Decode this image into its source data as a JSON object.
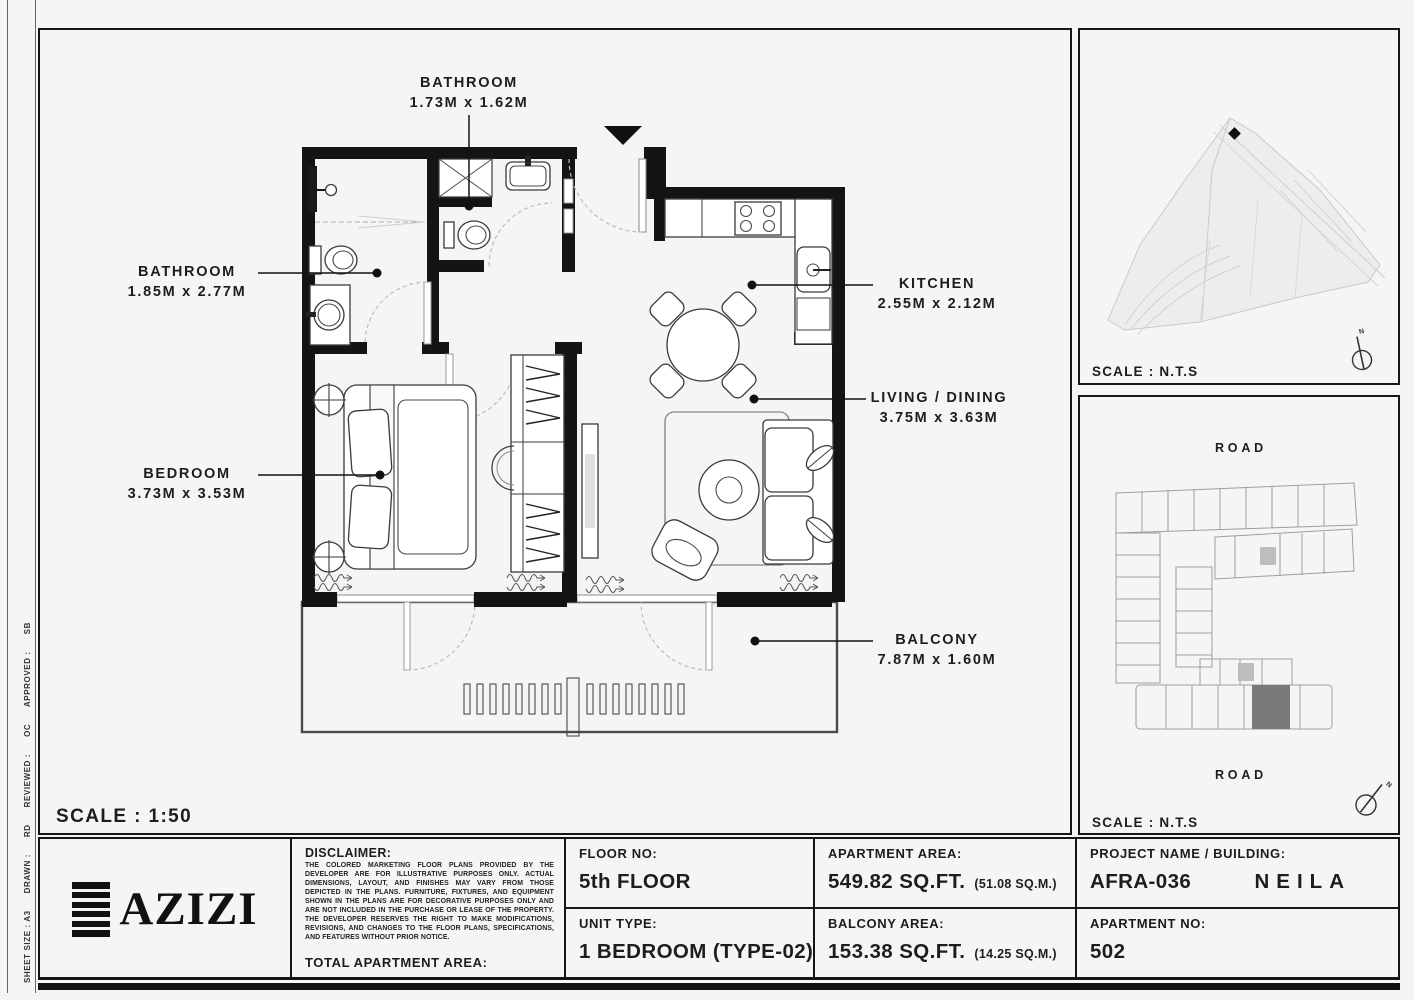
{
  "colors": {
    "wall": "#141414",
    "background": "#f5f5f3",
    "unit_highlight": "#7a7a7a",
    "line": "#1d1d1b"
  },
  "plan": {
    "scale_label": "SCALE : 1:50"
  },
  "rooms": [
    {
      "name": "BATHROOM",
      "dims": "1.73M x 1.62M"
    },
    {
      "name": "BATHROOM",
      "dims": "1.85M x 2.77M"
    },
    {
      "name": "KITCHEN",
      "dims": "2.55M x 2.12M"
    },
    {
      "name": "LIVING / DINING",
      "dims": "3.75M x 3.63M"
    },
    {
      "name": "BEDROOM",
      "dims": "3.73M x 3.53M"
    },
    {
      "name": "BALCONY",
      "dims": "7.87M x 1.60M"
    }
  ],
  "side_strip": {
    "text": "SHEET SIZE : A3      DRAWN :      RD      REVIEWED :      OC      APPROVED :      SB"
  },
  "panels": {
    "site_map": {
      "scale": "SCALE : N.T.S",
      "compass": "N"
    },
    "key_plan": {
      "road_top": "ROAD",
      "road_bottom": "ROAD",
      "scale": "SCALE : N.T.S",
      "compass": "N"
    }
  },
  "title_block": {
    "logo_text": "AZIZI",
    "floor_label": "FLOOR NO:",
    "floor_value": "5th FLOOR",
    "unit_label": "UNIT TYPE:",
    "unit_value": "1 BEDROOM (TYPE-02)",
    "apt_area_label": "APARTMENT AREA:",
    "apt_area_value": "549.82 SQ.FT.",
    "apt_area_metric": "(51.08 SQ.M.)",
    "balc_area_label": "BALCONY AREA:",
    "balc_area_value": "153.38 SQ.FT.",
    "balc_area_metric": "(14.25 SQ.M.)",
    "disclaimer_label": "DISCLAIMER:",
    "disclaimer_text": "THE COLORED MARKETING FLOOR PLANS PROVIDED BY THE DEVELOPER ARE FOR ILLUSTRATIVE PURPOSES ONLY. ACTUAL DIMENSIONS, LAYOUT, AND FINISHES MAY VARY FROM THOSE DEPICTED IN THE PLANS. FURNITURE, FIXTURES, AND EQUIPMENT SHOWN IN THE PLANS ARE FOR DECORATIVE PURPOSES ONLY AND ARE NOT INCLUDED IN THE PURCHASE OR LEASE OF THE PROPERTY. THE DEVELOPER RESERVES THE RIGHT TO MAKE MODIFICATIONS, REVISIONS, AND CHANGES TO THE FLOOR PLANS, SPECIFICATIONS, AND FEATURES WITHOUT PRIOR NOTICE.",
    "total_label": "TOTAL APARTMENT AREA:",
    "total_value": "703.20 SQ.FT.",
    "total_metric": "(65.33 SQ.M.)",
    "project_label": "PROJECT NAME / BUILDING:",
    "project_value": "AFRA-036",
    "building_value": "NEILA",
    "apt_no_label": "APARTMENT NO:",
    "apt_no_value": "502"
  }
}
